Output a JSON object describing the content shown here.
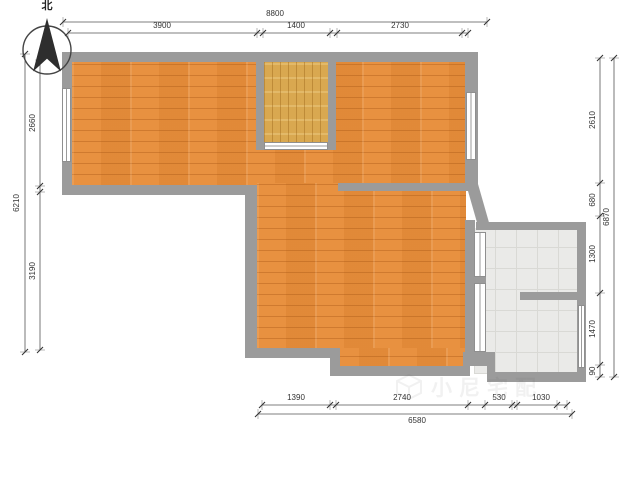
{
  "compass": {
    "label": "北"
  },
  "dimensions": {
    "top": {
      "overall": "8800",
      "segments": [
        "3900",
        "1400",
        "2730"
      ]
    },
    "left": {
      "overall": "6210",
      "segments": [
        "2660",
        "3190"
      ]
    },
    "right": {
      "overall": "6870",
      "segments": [
        "2610",
        "680",
        "1300",
        "1470",
        "90"
      ]
    },
    "bottom": {
      "overall": "6580",
      "segments": [
        "1390",
        "2740",
        "530",
        "1030"
      ]
    }
  },
  "watermark": {
    "text": "小尼宅配",
    "icon": "cube-icon"
  },
  "colors": {
    "wall": "#9b9b9b",
    "wood_floor": "#e89140",
    "alcove_wood": "#d9a850",
    "tile_floor": "#eaeae8",
    "dimension_text": "#333333"
  }
}
